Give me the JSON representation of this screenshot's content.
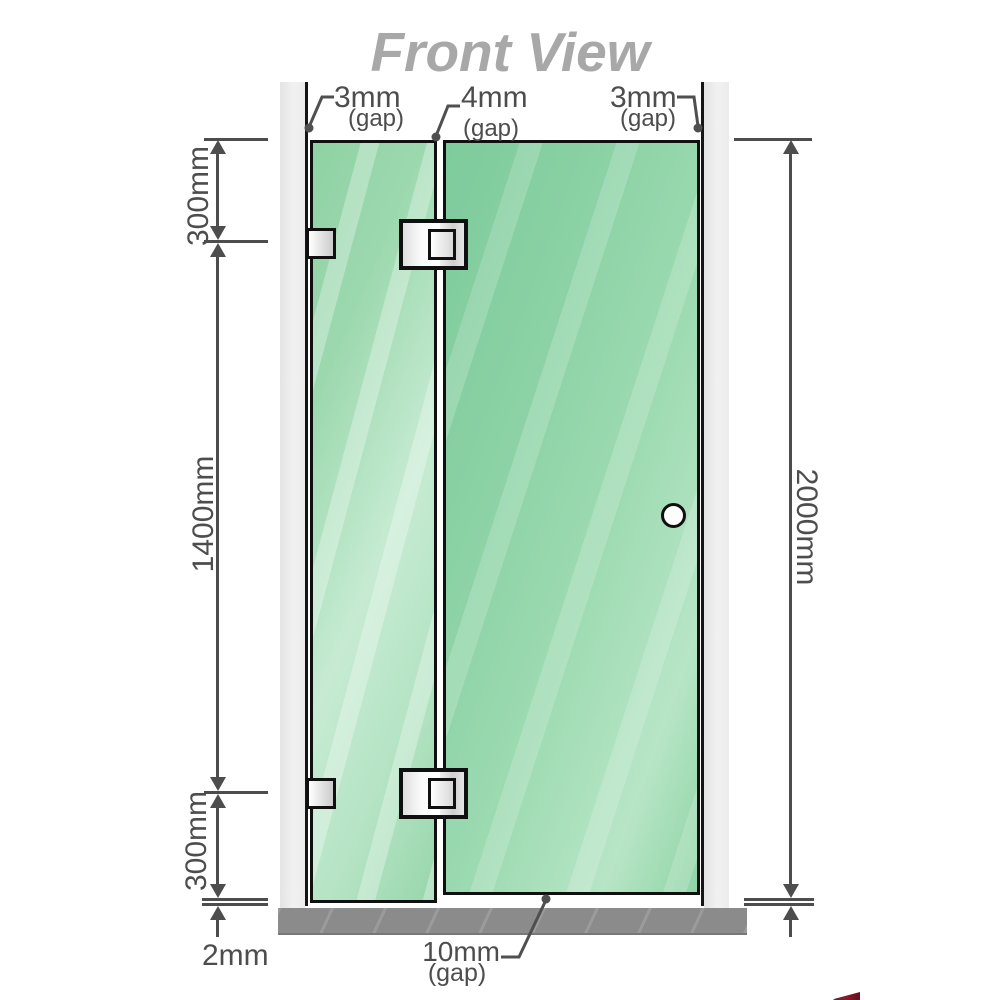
{
  "title": "Front View",
  "dimensions": {
    "gap_left_top": {
      "value": "3mm",
      "qualifier": "(gap)"
    },
    "gap_middle_top": {
      "value": "4mm",
      "qualifier": "(gap)"
    },
    "gap_right_top": {
      "value": "3mm",
      "qualifier": "(gap)"
    },
    "left_top_segment": "300mm",
    "left_middle_segment": "1400mm",
    "left_bottom_segment": "300mm",
    "floor_gap_left": "2mm",
    "total_height_right": "2000mm",
    "door_floor_gap": {
      "value": "10mm",
      "qualifier": "(gap)"
    }
  },
  "colors": {
    "glass_green": "#8fd2a4",
    "dimension_text": "#4d4d4d",
    "title_gray": "#a8a8a8",
    "wall_channel_gray": "#ececec",
    "floor_gray": "#8b8b8b",
    "hardware_silver": "#e0e0e0",
    "watermark_red": "#7a0d1f"
  }
}
